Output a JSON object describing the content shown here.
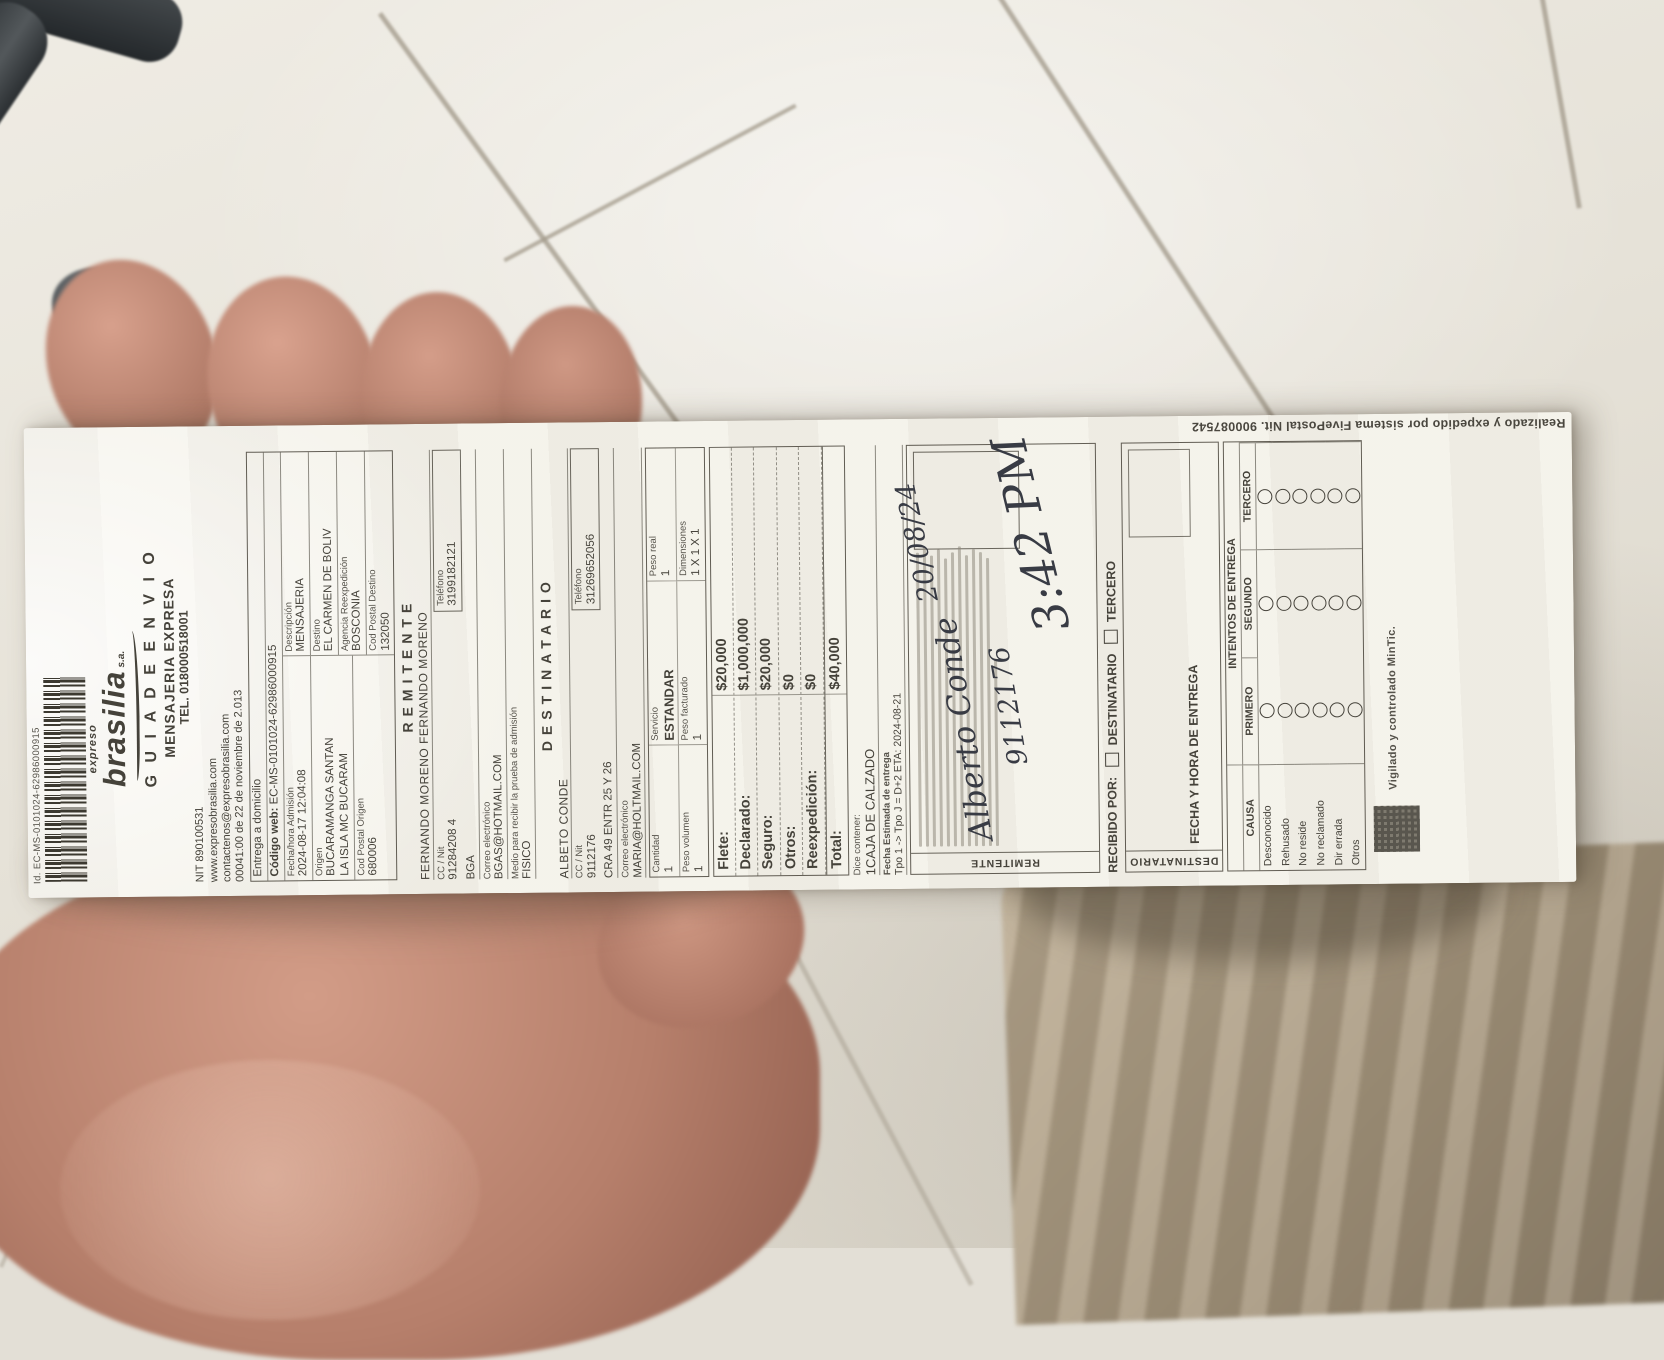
{
  "receipt": {
    "top_id": "Id. EC-MS-0101024-62986000915",
    "brand": {
      "pre": "expreso",
      "name": "brasilia",
      "suffix": "s.a."
    },
    "title1": "G U I A   D E   E N V I O",
    "title2": "MENSAJERIA EXPRESA",
    "tel": "TEL. 018000518001",
    "nit": "NIT 890100531",
    "web": "www.expresobrasilia.com",
    "email": "contactenos@expresobrasilia.com",
    "resolution": "00041:00 de 22 de noviembre de 2.013",
    "admision_box": {
      "entrega": "Entrega a domicilio",
      "codigo_web_label": "Código web:",
      "codigo_web": "EC-MS-0101024-62986000915",
      "fecha_label": "Fecha/hora Admisión",
      "fecha": "2024-08-17 12:04:08",
      "descripcion_label": "Descripción",
      "descripcion": "MENSAJERIA",
      "origen_label": "Origen",
      "origen": "BUCARAMANGA SANTAN",
      "origen2": "LA ISLA MC BUCARAM",
      "destino_label": "Destino",
      "destino": "EL CARMEN DE BOLIV",
      "agencia_label": "Agencia Reexpedición",
      "agencia": "BOSCONIA",
      "cp_origen_label": "Cod Postal Origen",
      "cp_origen": "680006",
      "cp_destino_label": "Cod Postal Destino",
      "cp_destino": "132050"
    },
    "remitente": {
      "header": "REMITENTE",
      "nombre": "FERNANDO MORENO FERNANDO MORENO",
      "cc_label": "CC / Nit",
      "cc": "91284208 4",
      "tel_label": "Teléfono",
      "tel": "3199182121",
      "ciudad": "BGA",
      "correo_label": "Correo electrónico",
      "correo": "BGAS@HOTMAIL.COM",
      "medio_label": "Medio para recibir la prueba de admisión",
      "medio": "FISICO"
    },
    "destinatario": {
      "header": "DESTINATARIO",
      "nombre": "ALBETO CONDE",
      "cc_label": "CC / Nit",
      "cc": "9112176",
      "tel_label": "Teléfono",
      "tel": "31269652056",
      "direccion": "CRA 49 ENTR 25 Y 26",
      "correo_label": "Correo electrónico",
      "correo": "MARIA@HOLTMAIL.COM"
    },
    "paquete": {
      "cantidad_label": "Cantidad",
      "cantidad": "1",
      "servicio_label": "Servicio",
      "servicio": "ESTANDAR",
      "peso_real_label": "Peso real",
      "peso_real": "1",
      "peso_vol_label": "Peso volumen",
      "peso_vol": "1",
      "peso_fact_label": "Peso facturado",
      "peso_fact": "1",
      "dim_label": "Dimensiones",
      "dim": "1 X 1 X 1"
    },
    "cargos": {
      "rows": [
        {
          "label": "Flete:",
          "value": "$20,000"
        },
        {
          "label": "Declarado:",
          "value": "$1,000,000"
        },
        {
          "label": "Seguro:",
          "value": "$20,000"
        },
        {
          "label": "Otros:",
          "value": "$0"
        },
        {
          "label": "Reexpedición:",
          "value": "$0"
        },
        {
          "label": "Total:",
          "value": "$40,000"
        }
      ]
    },
    "contenido": {
      "label": "Dice contener:",
      "value": "1CAJA DE CALZADO"
    },
    "eta": {
      "label": "Fecha Estimada de entrega",
      "value": "Tpo 1 -> Tpo J = D+2 ETA: 2024-08-21"
    },
    "firmas": {
      "remitente": "REMITENTE",
      "destinatario": "DESTINATARIO"
    },
    "handwriting": {
      "name": "Alberto Conde",
      "id": "9112176",
      "date": "20/08/24",
      "time": "3:42 PM"
    },
    "recibido": {
      "label": "RECIBIDO POR:",
      "opt1": "DESTINATARIO",
      "opt2": "TERCERO"
    },
    "entrega": {
      "fecha_label": "FECHA Y HORA DE ENTREGA",
      "intentos_label": "INTENTOS DE ENTREGA",
      "causa_label": "CAUSA",
      "col1": "PRIMERO",
      "col2": "SEGUNDO",
      "col3": "TERCERO",
      "causas": [
        "Desconocido",
        "Rehusado",
        "No reside",
        "No reclamado",
        "Dir errada",
        "Otros"
      ]
    },
    "footer": {
      "vigilado": "Vigilado y controlado MinTic.",
      "sistema": "Realizado y expedido por sistema FivePostal Nit. 900087542"
    },
    "colors": {
      "paper": "#f4f2ea",
      "ink": "#45423a",
      "pen": "#383b44",
      "floor": "#e6e2d8",
      "grout": "#a59d8e",
      "skin": "#c4907c",
      "pants": "#b4a58e",
      "chair": "#383d40"
    }
  }
}
